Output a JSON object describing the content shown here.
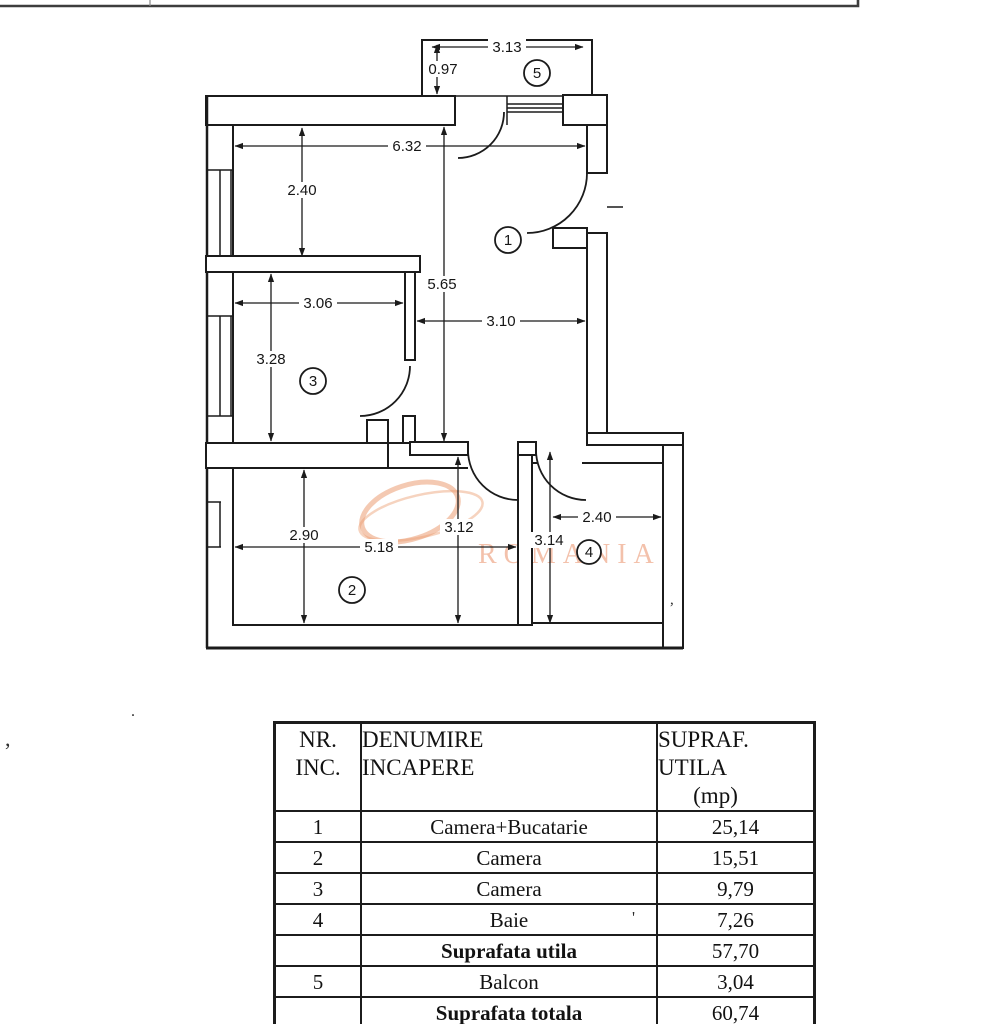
{
  "plan": {
    "rooms": [
      {
        "id": "1"
      },
      {
        "id": "2"
      },
      {
        "id": "3"
      },
      {
        "id": "4"
      },
      {
        "id": "5"
      }
    ],
    "dims": [
      {
        "label": "3.13"
      },
      {
        "label": "0.97"
      },
      {
        "label": "6.32"
      },
      {
        "label": "2.40"
      },
      {
        "label": "5.65"
      },
      {
        "label": "3.06"
      },
      {
        "label": "3.28"
      },
      {
        "label": "3.10"
      },
      {
        "label": "2.90"
      },
      {
        "label": "5.18"
      },
      {
        "label": "3.12"
      },
      {
        "label": "3.14"
      },
      {
        "label": "2.40"
      }
    ],
    "watermark": "ROMANIA"
  },
  "table": {
    "header": {
      "col1_line1": "NR.",
      "col1_line2": "INC.",
      "col2_line1": "DENUMIRE",
      "col2_line2": "INCAPERE",
      "col3_line1": "SUPRAF.",
      "col3_line2": "UTILA",
      "col3_line3": "(mp)"
    },
    "rows": [
      {
        "nr": "1",
        "name": "Camera+Bucatarie",
        "value": "25,14"
      },
      {
        "nr": "2",
        "name": "Camera",
        "value": "15,51"
      },
      {
        "nr": "3",
        "name": "Camera",
        "value": "9,79"
      },
      {
        "nr": "4",
        "name": "Baie",
        "value": "7,26"
      },
      {
        "nr": "",
        "name": "Suprafata utila",
        "value": "57,70"
      },
      {
        "nr": "5",
        "name": "Balcon",
        "value": "3,04"
      },
      {
        "nr": "",
        "name": "Suprafata totala",
        "value": "60,74"
      },
      {
        "nr": "",
        "name": "Suprafata construita",
        "value": "78,00"
      }
    ]
  },
  "marks": {
    "comma": ",",
    "dot": ".",
    "apostrophe": "'"
  }
}
